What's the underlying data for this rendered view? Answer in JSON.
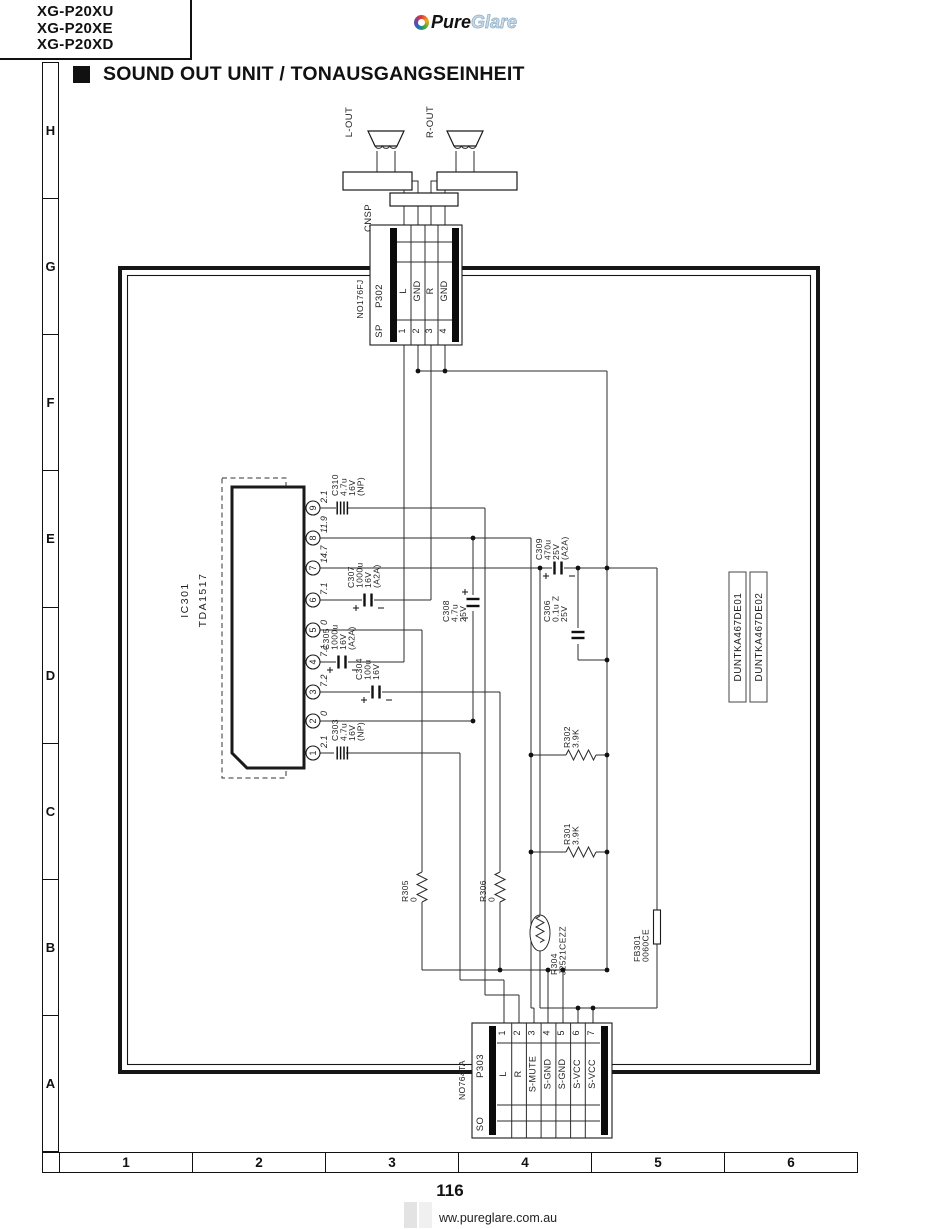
{
  "header": {
    "models": [
      "XG-P20XU",
      "XG-P20XE",
      "XG-P20XD"
    ],
    "logo_pure": "Pure",
    "logo_glare": "Glare",
    "title": "SOUND OUT UNIT / TONAUSGANGSEINHEIT"
  },
  "ruler": {
    "rows": [
      "H",
      "G",
      "F",
      "E",
      "D",
      "C",
      "B",
      "A"
    ],
    "cols": [
      "1",
      "2",
      "3",
      "4",
      "5",
      "6"
    ]
  },
  "footer": {
    "page": "116",
    "site": "ww.pureglare.com.au"
  },
  "colors": {
    "line": "#2b2b2b",
    "logo_glare": "#c6dbe9"
  },
  "schematic": {
    "cnsp_label": "CNSP",
    "speaker_left": "L-OUT",
    "speaker_right": "R-OUT",
    "p302": {
      "part": "NO176FJ",
      "ref": "P302",
      "tag": "SP",
      "pins": [
        {
          "n": "1",
          "signal": "L"
        },
        {
          "n": "2",
          "signal": "GND"
        },
        {
          "n": "3",
          "signal": "R"
        },
        {
          "n": "4",
          "signal": "GND"
        }
      ]
    },
    "p303": {
      "part": "NO764TA",
      "ref": "P303",
      "tag": "SO",
      "pins": [
        {
          "n": "1",
          "signal": "L"
        },
        {
          "n": "2",
          "signal": "R"
        },
        {
          "n": "3",
          "signal": "S-MUTE"
        },
        {
          "n": "4",
          "signal": "S-GND"
        },
        {
          "n": "5",
          "signal": "S-GND"
        },
        {
          "n": "6",
          "signal": "S-VCC"
        },
        {
          "n": "7",
          "signal": "S-VCC"
        }
      ]
    },
    "ic301": {
      "ref": "IC301",
      "part": "TDA1517",
      "pin_voltages": [
        {
          "n": "1",
          "v": "2.1"
        },
        {
          "n": "2",
          "v": "0"
        },
        {
          "n": "3",
          "v": "7.2"
        },
        {
          "n": "4",
          "v": "7.1"
        },
        {
          "n": "5",
          "v": "0"
        },
        {
          "n": "6",
          "v": "7.1"
        },
        {
          "n": "7",
          "v": "14.7"
        },
        {
          "n": "8",
          "v": "11.9"
        },
        {
          "n": "9",
          "v": "2.1"
        }
      ]
    },
    "capacitors": {
      "c303": [
        "C303",
        "4.7u",
        "16V",
        "(NP)"
      ],
      "c304": [
        "C304",
        "100u",
        "16V"
      ],
      "c305": [
        "C305",
        "1000u",
        "16V",
        "(A2A)"
      ],
      "c306": [
        "C306",
        "0.1u Z",
        "25V"
      ],
      "c307": [
        "C307",
        "1000u",
        "16V",
        "(A2A)"
      ],
      "c308": [
        "C308",
        "4.7u",
        "25V"
      ],
      "c309": [
        "C309",
        "470u",
        "25V",
        "(A2A)"
      ],
      "c310": [
        "C310",
        "4.7u",
        "16V",
        "(NP)"
      ]
    },
    "resistors": {
      "r301": [
        "R301",
        "3.9K"
      ],
      "r302": [
        "R302",
        "3.9K"
      ],
      "r304": [
        "R304",
        "J2521CEZZ"
      ],
      "r305": [
        "R305",
        "0"
      ],
      "r306": [
        "R306",
        "0"
      ]
    },
    "ferrite_bead": [
      "FB301",
      "0060CE"
    ],
    "board_ids": [
      "DUNTKA467DE01",
      "DUNTKA467DE02"
    ]
  }
}
